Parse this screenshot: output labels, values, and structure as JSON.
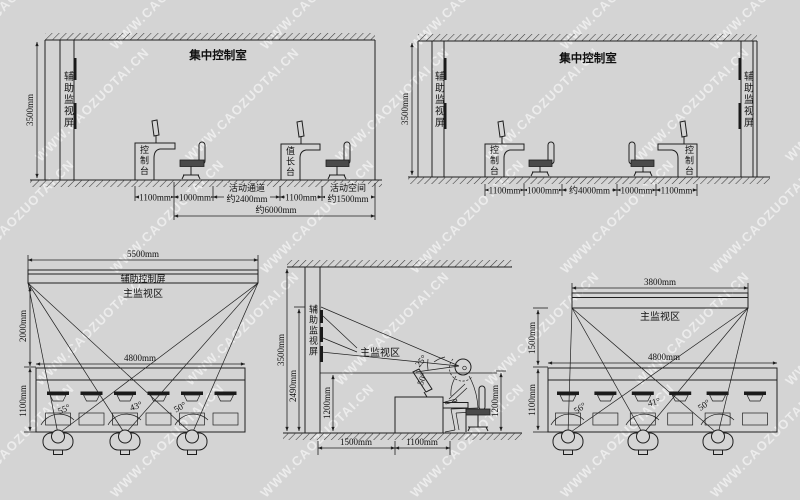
{
  "watermark": {
    "text": "WWW.CAOZUOTAI.CN"
  },
  "top_left": {
    "title": "集中控制室",
    "height_label": "3500mm",
    "aux_screen_label": "辅助监视屏",
    "console_label": "控制台",
    "chief_desk_label": "值长台",
    "dim_1100a": "1100mm",
    "dim_1000": "1000mm",
    "walkway_name": "活动通道",
    "walkway_value": "约2400mm",
    "dim_1100b": "1100mm",
    "space_name": "活动空间",
    "space_value": "约1500mm",
    "total": "约6000mm"
  },
  "top_right": {
    "title": "集中控制室",
    "height_label": "3500mm",
    "aux_screen_left": "辅助监视屏",
    "aux_screen_right": "辅助监视屏",
    "console_left": "控制台",
    "console_right": "控制台",
    "dim_1100a": "1100mm",
    "dim_1000a": "1000mm",
    "dim_4000": "约4000mm",
    "dim_1000b": "1000mm",
    "dim_1100b": "1100mm"
  },
  "bottom_left": {
    "width_label": "5500mm",
    "screen_label": "辅助控制屏",
    "zone_label": "主监视区",
    "height_label": "2000mm",
    "console_width": "4800mm",
    "console_depth": "1100mm",
    "angle1": "55°",
    "angle2": "43°",
    "angle3": "50°"
  },
  "bottom_middle": {
    "height_label": "3500mm",
    "screen_height": "2490mm",
    "aux_screen_label": "辅助监视屏",
    "zone_label": "主监视区",
    "angle_up": "25°",
    "angle_down": "50°",
    "level_left": "1200mm",
    "level_right": "1200mm",
    "dist_wall": "1500mm",
    "dist_desk": "1100mm"
  },
  "bottom_right": {
    "width_label": "3800mm",
    "zone_label": "主监视区",
    "height_label": "1500mm",
    "console_width": "4800mm",
    "console_depth": "1100mm",
    "angle1": "56°",
    "angle2": "41°",
    "angle3": "50°"
  }
}
